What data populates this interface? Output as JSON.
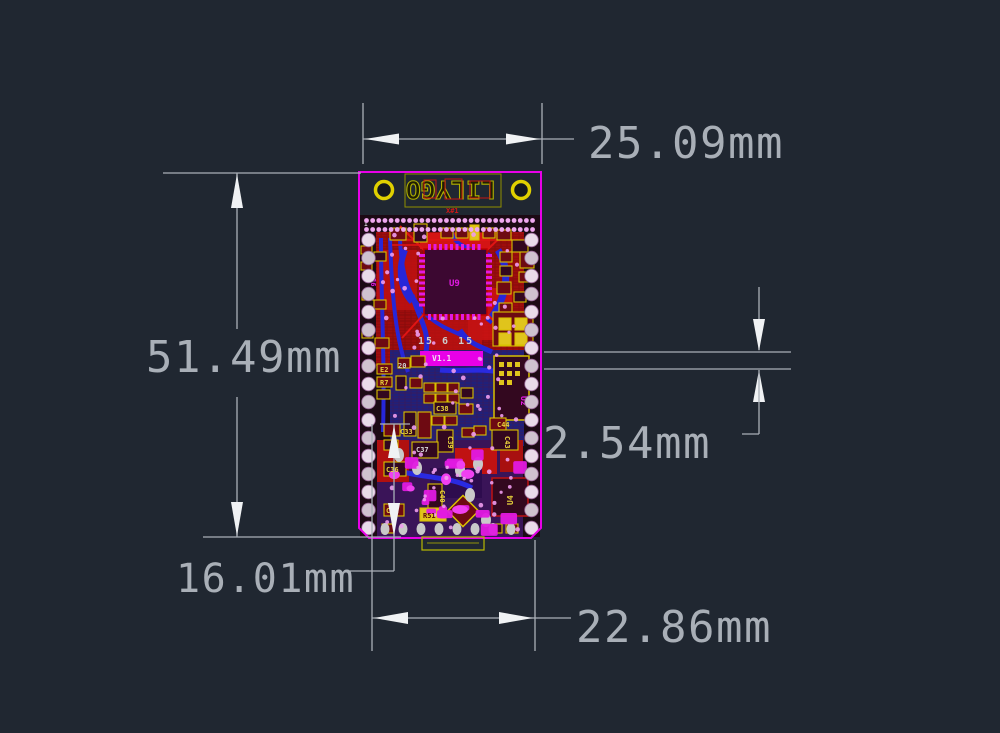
{
  "page": {
    "title": "PCB dimensioned CAD drawing",
    "background": "#202731"
  },
  "dimensions": {
    "top_width": {
      "value": "25.09mm"
    },
    "left_height": {
      "value": "51.49mm"
    },
    "right_pitch": {
      "value": "2.54mm"
    },
    "lower_left": {
      "value": "16.01mm"
    },
    "bottom_width": {
      "value": "22.86mm"
    }
  },
  "board": {
    "colors": {
      "outline": "#e800e8",
      "copper": "#9e0d0d",
      "trace_blue": "#2626d8",
      "silkscreen": "#d8c000",
      "dimension_lines": "#aab0b8"
    },
    "labels": {
      "logo": "LILYGO",
      "assembly": "X#1",
      "chip": "U9",
      "date_code": "15 6 15",
      "version": "V1.1",
      "shield": "U2",
      "usb_ic": "U4",
      "r51": "R51",
      "r7": "R7",
      "e2": "E2",
      "c20": "20",
      "c33": "C33",
      "c36": "C36",
      "c37": "C37",
      "c38": "C38",
      "c39": "C39",
      "c40": "C40",
      "c41": "C41",
      "c43": "C43",
      "c44": "C44",
      "pin1": "1",
      "pin36": "36"
    }
  }
}
